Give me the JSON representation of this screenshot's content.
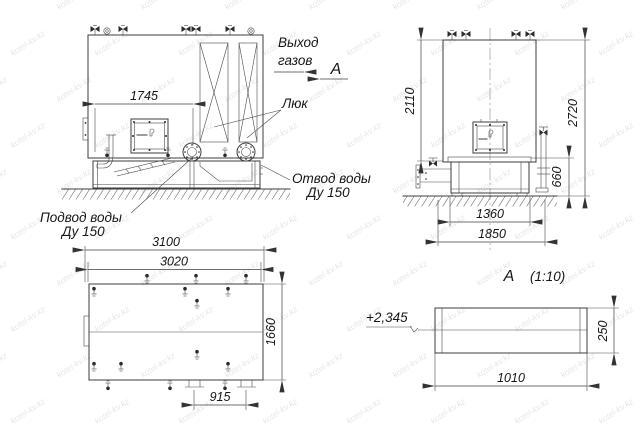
{
  "front": {
    "dim_width": "1745",
    "gas1": "Выход",
    "gas2": "газов",
    "view_mark": "А",
    "hatch_label": "Люк",
    "outlet1": "Отвод воды",
    "outlet2": "Ду 150",
    "inlet1": "Подвод воды",
    "inlet2": "Ду 150"
  },
  "side": {
    "dim_tank_h": "2110",
    "dim_total_h": "2720",
    "dim_base_h": "660",
    "dim_base_w": "1360",
    "dim_total_w": "1850"
  },
  "top": {
    "dim_overall": "3100",
    "dim_body": "3020",
    "dim_depth": "1660",
    "dim_feet": "915"
  },
  "detail": {
    "letter": "А",
    "scale": "(1:10)",
    "elevation": "+2,345",
    "dim_h": "250",
    "dim_w": "1010"
  },
  "watermark": {
    "text": "kotel-kv.kz"
  },
  "colors": {
    "line": "#3c3c3c",
    "text": "#161616",
    "ground_hatch": "#8f8f8f",
    "background": "#ffffff",
    "watermark": "#d3d6dd"
  }
}
